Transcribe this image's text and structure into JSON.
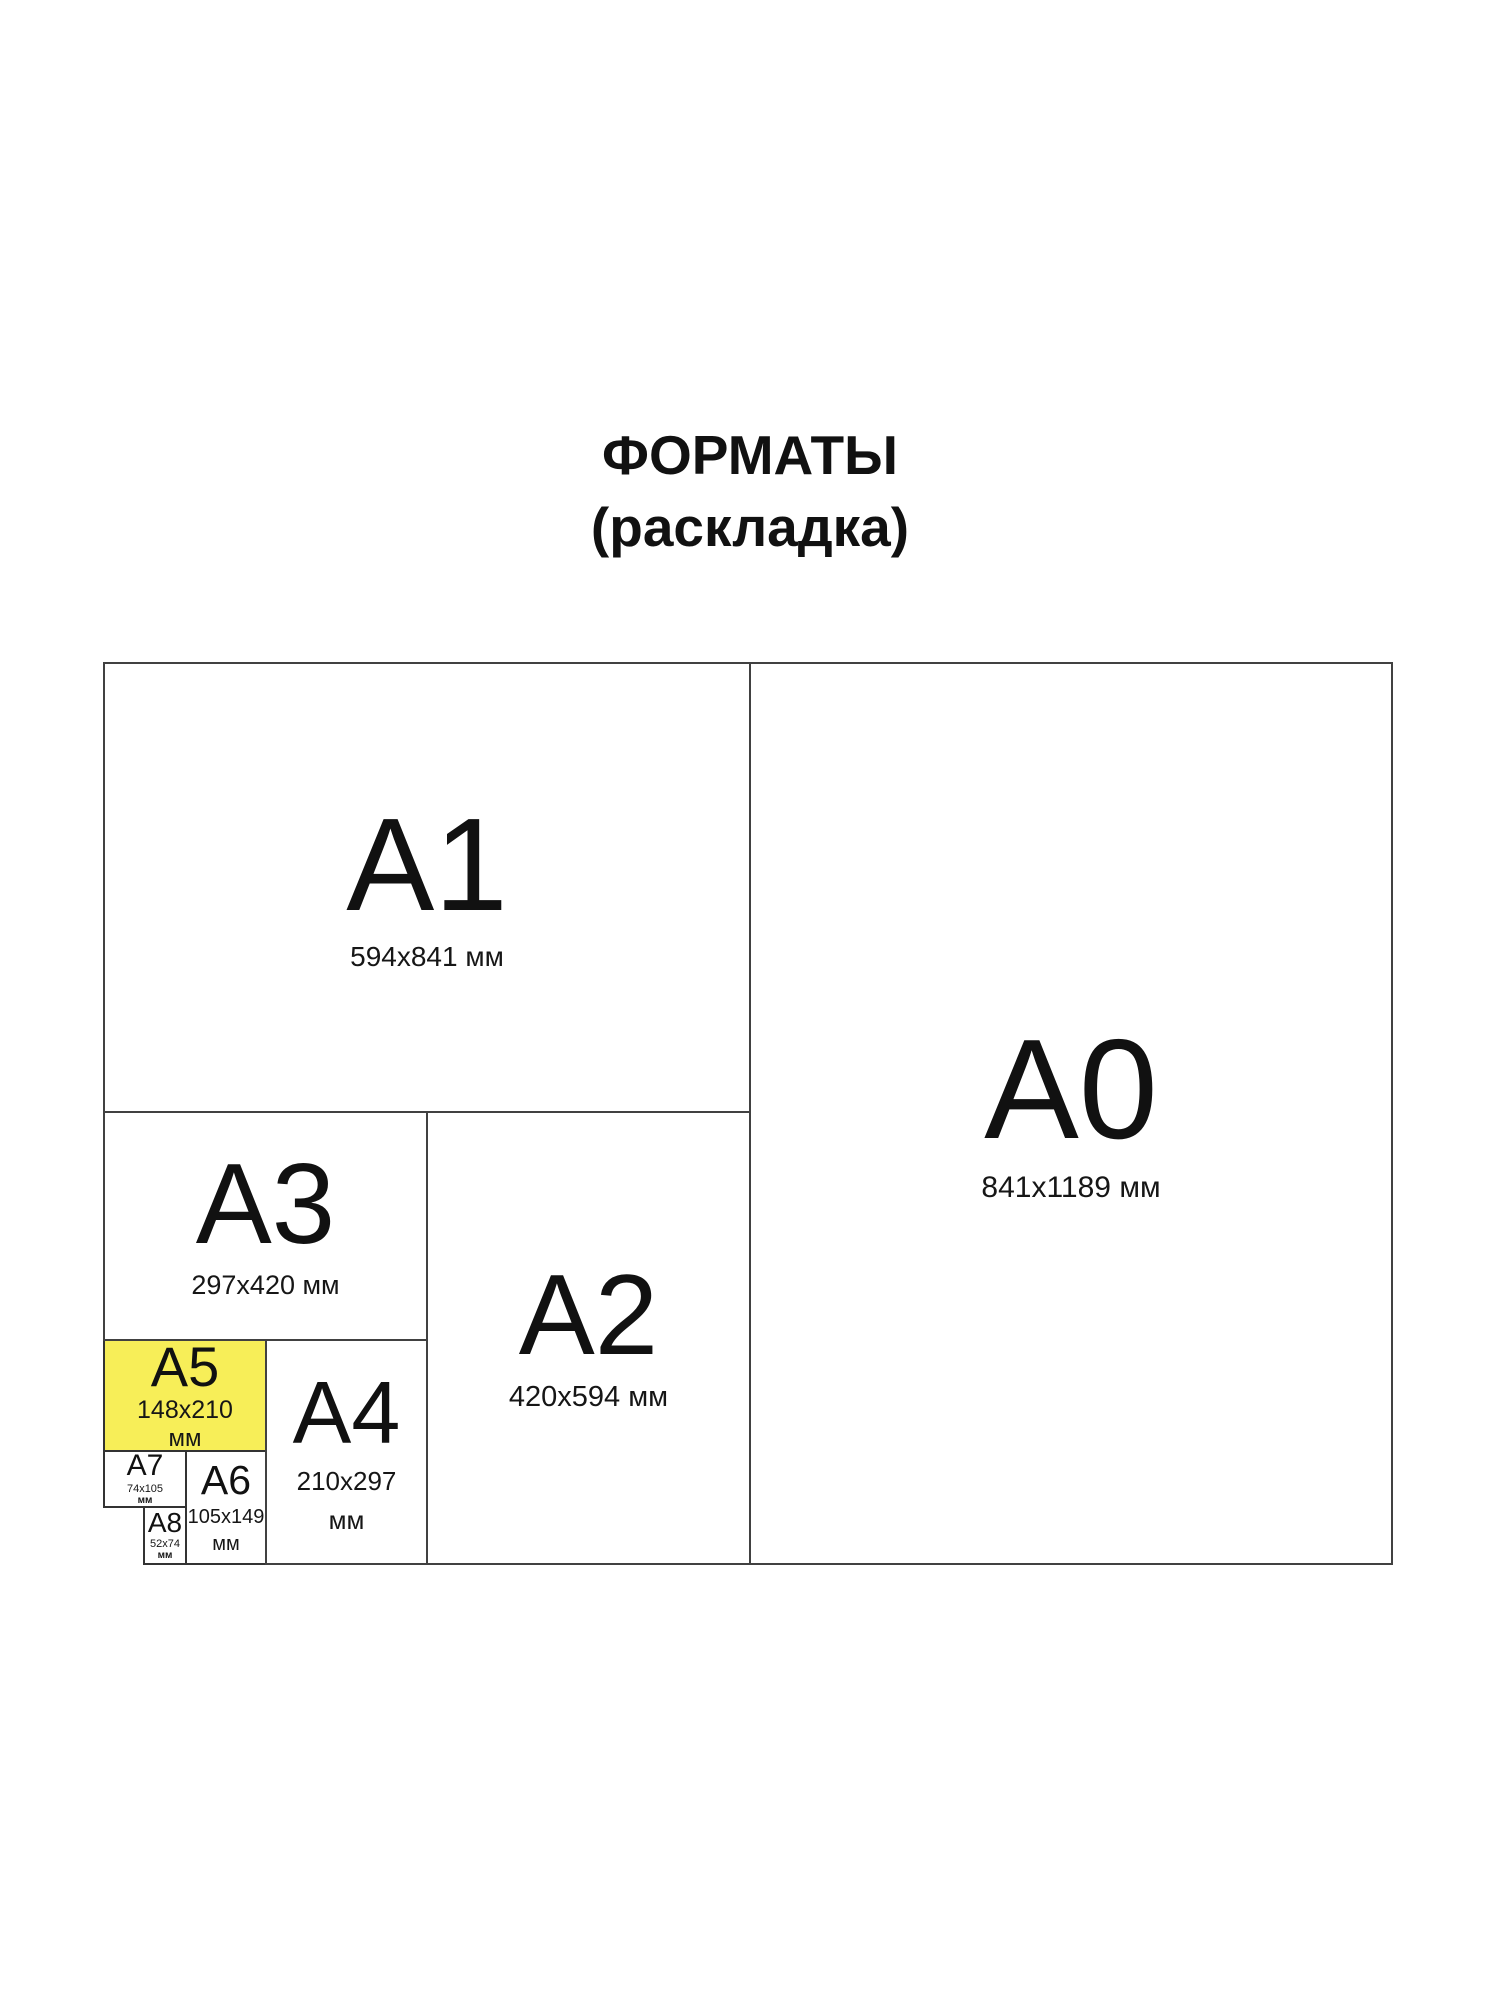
{
  "title": {
    "line1": "ФОРМАТЫ",
    "line2": "(раскладка)"
  },
  "highlight_color": "#F7EE58",
  "text_color": "#111111",
  "line_color": "#414141",
  "background_color": "#ffffff",
  "formats": {
    "a0": {
      "name": "A0",
      "size": "841x1189 мм"
    },
    "a1": {
      "name": "A1",
      "size": "594x841 мм"
    },
    "a2": {
      "name": "A2",
      "size": "420x594 мм"
    },
    "a3": {
      "name": "A3",
      "size": "297x420 мм"
    },
    "a4": {
      "name": "A4",
      "size": "210x297",
      "unit": "мм"
    },
    "a5": {
      "name": "A5",
      "size": "148x210",
      "unit": "мм",
      "highlighted": true
    },
    "a6": {
      "name": "A6",
      "size": "105x149",
      "unit": "мм"
    },
    "a7": {
      "name": "A7",
      "size": "74x105",
      "unit": "мм"
    },
    "a8": {
      "name": "A8",
      "size": "52x74",
      "unit": "мм"
    }
  }
}
